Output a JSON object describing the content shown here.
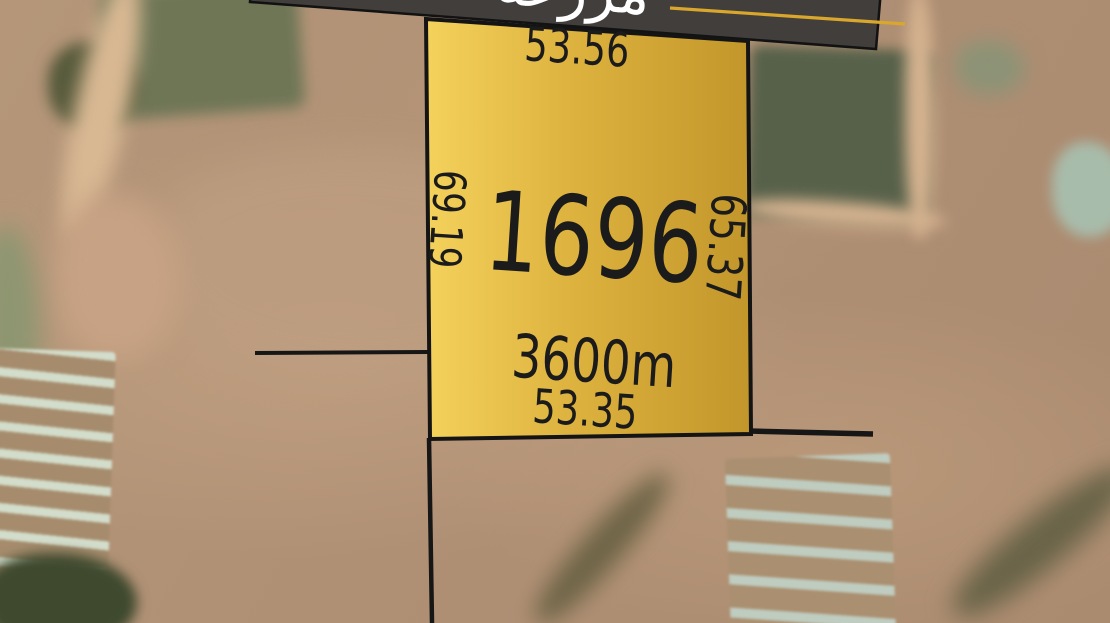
{
  "banner": {
    "title_partial": "مزرعة",
    "background_color": "#413e3c",
    "underline_color": "#d9a72c",
    "text_color": "#ffffff"
  },
  "parcel": {
    "number": "1696",
    "area_label": "3600m",
    "dimensions": {
      "top": "53.56",
      "left": "69.19",
      "right": "65.37",
      "bottom": "53.35"
    },
    "fill_color_light": "#f4d25c",
    "fill_color_dark": "#c2962a",
    "border_color": "#141414",
    "label_color": "#1b1b1b"
  }
}
